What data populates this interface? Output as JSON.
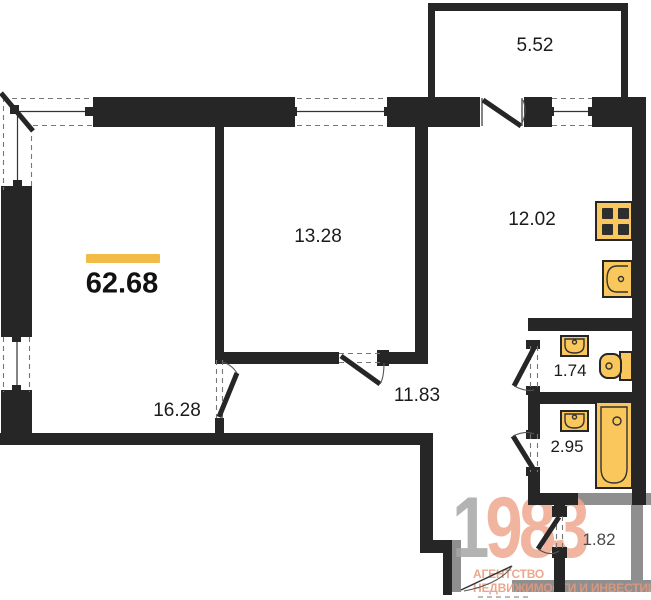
{
  "total_area": "62.68",
  "rooms": {
    "balcony": {
      "area": "5.52"
    },
    "bedroom": {
      "area": "13.28"
    },
    "kitchen": {
      "area": "12.02"
    },
    "living": {
      "area": "16.28"
    },
    "hallway": {
      "area": "11.83"
    },
    "wc": {
      "area": "1.74"
    },
    "bathroom": {
      "area": "2.95"
    },
    "storage": {
      "area": "1.82"
    }
  },
  "fixtures": {
    "stove": "stove-icon",
    "kitchen_sink": "sink-icon",
    "wc_sink": "sink-icon",
    "toilet": "toilet-icon",
    "bath_sink": "sink-icon",
    "bathtub": "bathtub-icon"
  },
  "logo": {
    "digit_gray": "1",
    "digits_accent": "983",
    "tagline_line1": "АГЕНТСТВО",
    "tagline_line2": "НЕДВИЖИМОСТИ И ИНВЕСТИЦИЙ"
  },
  "colors": {
    "wall": "#262626",
    "outside": "#8F8F8F",
    "accent": "#F0BC47",
    "fixture": "#F9C75B",
    "logo_gray": "#A6A6A6",
    "logo_accent": "#EFA78E",
    "logo_text": "#E8997C",
    "label": "#1B1B1B"
  }
}
